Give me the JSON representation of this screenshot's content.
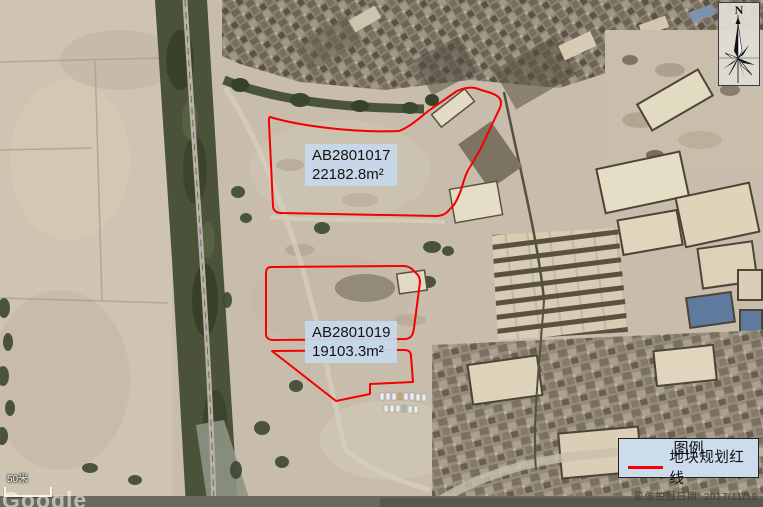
{
  "parcels": [
    {
      "code": "AB2801017",
      "area": "22182.8m²"
    },
    {
      "code": "AB2801019",
      "area": "19103.3m²"
    }
  ],
  "legend": {
    "title": "图例",
    "items": [
      {
        "symbol": "red-line",
        "label": "地块规划红线",
        "color": "#FF0000"
      }
    ]
  },
  "compass": {
    "north_label": "N"
  },
  "scale_bar": {
    "label": "50米"
  },
  "watermarks": {
    "imagery_provider": "Google",
    "imagery_date": "影像拍摄日期: 2017/11/18"
  },
  "colors": {
    "parcel_outline": "#FF0000",
    "parcel_label_background": "#C6D8EA",
    "legend_background": "#CCDCEC"
  }
}
